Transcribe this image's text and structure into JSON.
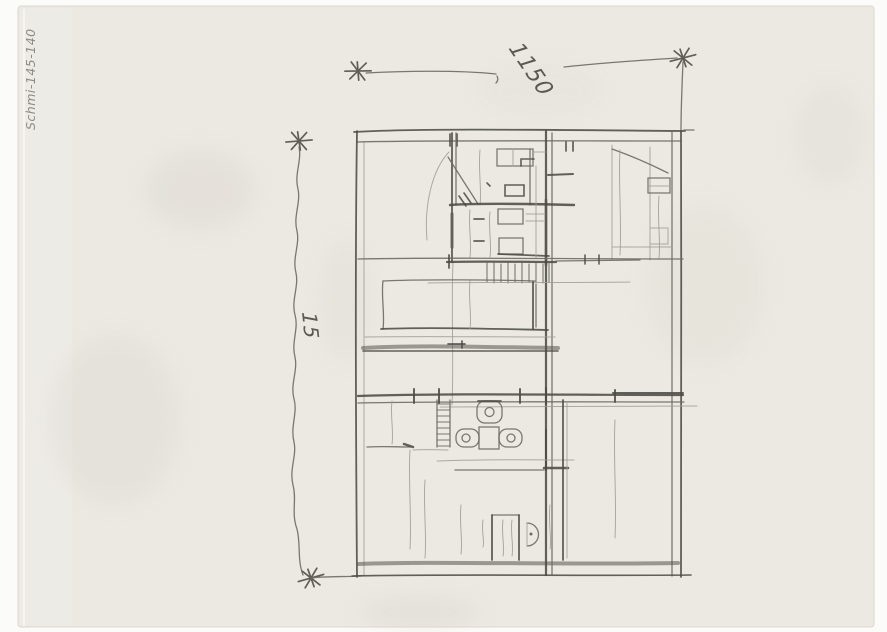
{
  "labels": {
    "dimension_top": "1150",
    "dimension_left": "15",
    "archive_code": "Schmi-145-140"
  },
  "colors": {
    "paper": "#ebe9e2",
    "paper_edge": "#f6f5f1",
    "bg": "#fbfbfa",
    "graphite_dark": "#4c4b46",
    "graphite": "#6c6b64",
    "graphite_light": "#a19e95",
    "stain": "#d6d2c7"
  },
  "drawing": {
    "type": "hand-drawn architectural floor plan, pencil on tracing paper",
    "elements": [
      "outer-walls",
      "center-wall",
      "stair-hatch",
      "kitchen-core",
      "toilet-fixture",
      "wash-basins",
      "shower-stall",
      "round-sink",
      "dimension-line-top",
      "dimension-line-left",
      "star-dimension-markers",
      "archive-code-label"
    ]
  }
}
